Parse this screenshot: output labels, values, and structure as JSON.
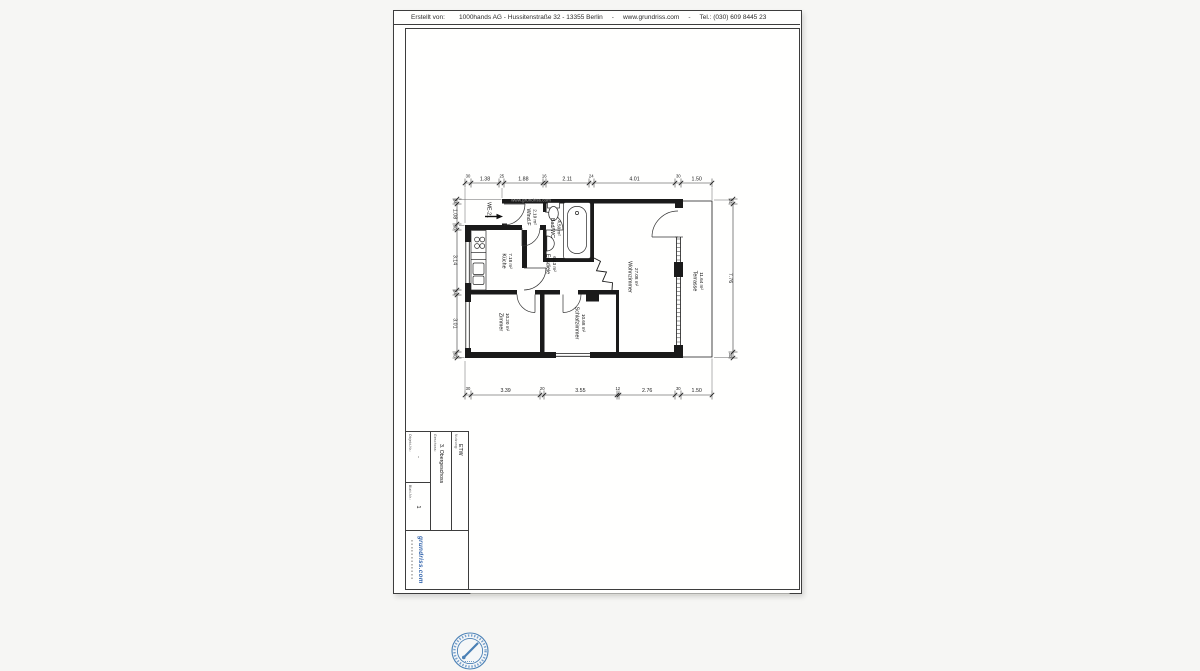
{
  "header": {
    "label": "Erstellt von:",
    "company": "1000hands AG - Hussitenstraße 32 - 13355 Berlin",
    "sep1": "-",
    "website": "www.grundriss.com",
    "sep2": "-",
    "phone": "Tel.: (030) 609 8445 23"
  },
  "plan": {
    "watermark": "www.grundriss.com",
    "unit_label": "WE-21",
    "rooms": [
      {
        "name": "Wind.F",
        "area": "2.19 m²"
      },
      {
        "name": "Bad/WC",
        "area": "4.50 m²"
      },
      {
        "name": "Küche",
        "area": "7.18 m²"
      },
      {
        "name": "Essdiele",
        "area": "6.43 m²"
      },
      {
        "name": "Wohnzimmer",
        "area": "27.08 m²"
      },
      {
        "name": "Terrasse",
        "area": "11.64 m²"
      },
      {
        "name": "Zimmer",
        "area": "10.20 m²"
      },
      {
        "name": "Schlafzimmer",
        "area": "10.68 m²"
      }
    ],
    "dimensions": {
      "top": [
        "30",
        "1.38",
        "25",
        "1.88",
        "16",
        "2.11",
        "24",
        "4.01",
        "30",
        "1.50"
      ],
      "bottom": [
        "30",
        "3.39",
        "20",
        "3.55",
        "12",
        "2.76",
        "30",
        "1.50"
      ],
      "left": [
        "24",
        "1.08",
        "30",
        "3.14",
        "24",
        "3.01",
        "30"
      ],
      "right": [
        "24",
        "7.76",
        "30"
      ]
    }
  },
  "title_block": {
    "object_no_label": "Objekt-Nr.:",
    "object_no_value": "-",
    "sheet_no_label": "Blatt-Nr.:",
    "sheet_no_value": "1",
    "floor_label": "Geschoss:",
    "floor_value": "3. Obergeschoss",
    "usage_label": "Nutzung:",
    "usage_value": "ETW",
    "logo": "grundriss.com"
  },
  "colors": {
    "line": "#1a1a1a",
    "logo_blue": "#2b5ea8",
    "seal_blue": "#4a80b5",
    "watermark_gray": "#a0a0a0"
  }
}
